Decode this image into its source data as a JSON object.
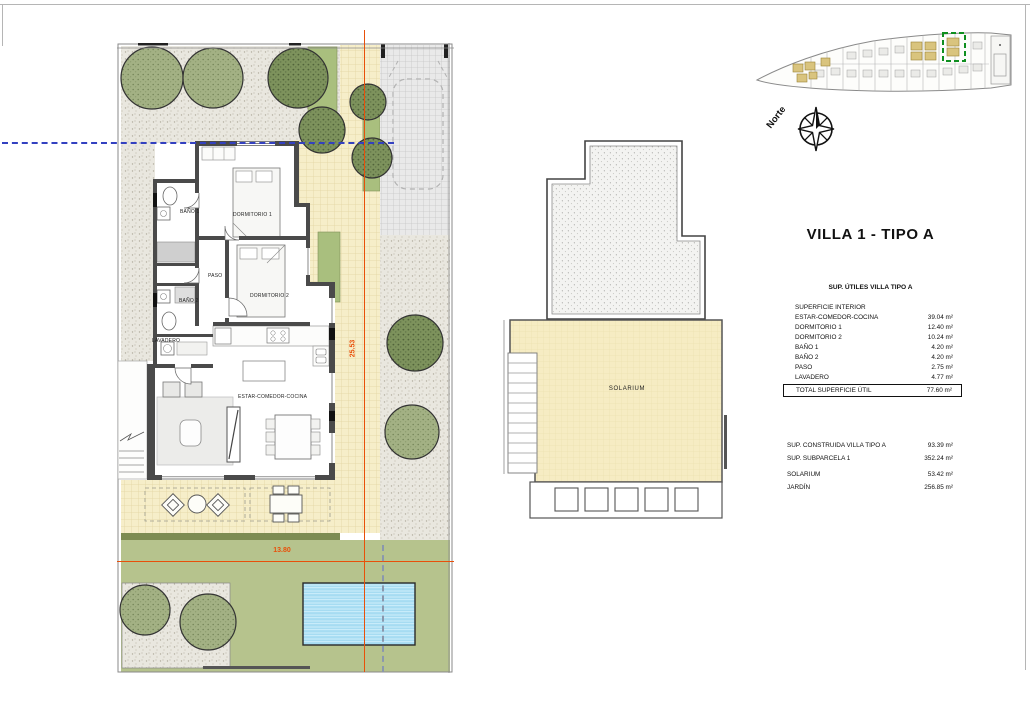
{
  "page": {
    "title": "VILLA 1 - TIPO A"
  },
  "location_map": {
    "north_label": "Norte"
  },
  "site_plan": {
    "rooms": {
      "bano1": "BAÑO 1",
      "dormitorio1": "DORMITORIO 1",
      "paso": "PASO",
      "bano2": "BAÑO 2",
      "dormitorio2": "DORMITORIO 2",
      "lavadero": "LAVADERO",
      "estar": "ESTAR-COMEDOR-COCINA"
    },
    "dimensions": {
      "height": "25.53",
      "width": "13.80"
    }
  },
  "solarium_plan": {
    "label": "SOLARIUM"
  },
  "areas_table": {
    "title": "SUP. ÚTILES VILLA TIPO A",
    "section": "SUPERFICIE INTERIOR",
    "rows": [
      {
        "label": "ESTAR-COMEDOR-COCINA",
        "value": "39.04 m²"
      },
      {
        "label": "DORMITORIO 1",
        "value": "12.40 m²"
      },
      {
        "label": "DORMITORIO 2",
        "value": "10.24 m²"
      },
      {
        "label": "BAÑO 1",
        "value": "4.20 m²"
      },
      {
        "label": "BAÑO 2",
        "value": "4.20 m²"
      },
      {
        "label": "PASO",
        "value": "2.75 m²"
      },
      {
        "label": "LAVADERO",
        "value": "4.77 m²"
      }
    ],
    "total": {
      "label": "TOTAL SUPERFICIE ÚTIL",
      "value": "77.60 m²"
    }
  },
  "summary_table": {
    "rows": [
      {
        "label": "SUP. CONSTRUIDA VILLA TIPO A",
        "value": "93.39 m²"
      },
      {
        "label": "SUP. SUBPARCELA 1",
        "value": "352.24 m²"
      },
      {
        "label": "SOLARIUM",
        "value": "53.42 m²"
      },
      {
        "label": "JARDÍN",
        "value": "256.85 m²"
      }
    ]
  },
  "colors": {
    "dimension_orange": "#e8500a",
    "axis_blue_dashed": "#3340c0",
    "highlight_green": "#0f8f1f",
    "lawn_green": "#b6c38d",
    "tile_yellow": "#f6eec9",
    "pool_blue": "#a6dcf2",
    "plot_tan": "#d9c47e"
  }
}
